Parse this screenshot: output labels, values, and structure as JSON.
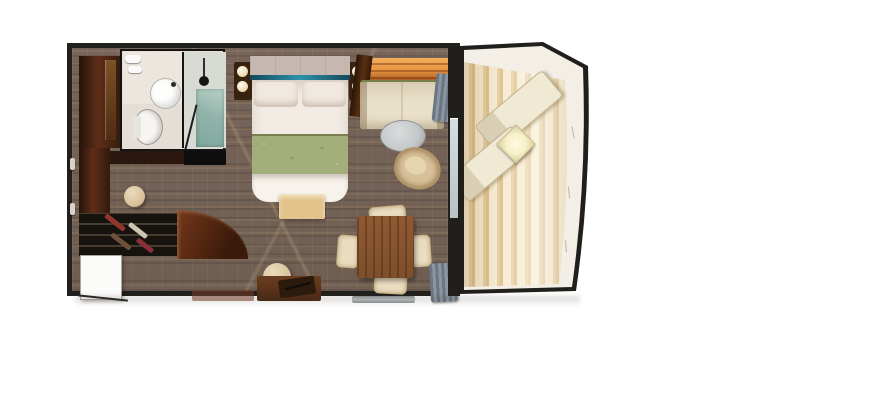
{
  "meta": {
    "title": "Balcony stateroom floor plan",
    "description": "Top-down 3D rendered floor plan of a cruise-ship balcony stateroom with bathroom, dressing area, bedroom, living-dining area and private balcony"
  },
  "rooms": {
    "entry": {
      "label": "Entry with wardrobe and shoe shelves"
    },
    "bathroom": {
      "label": "Bathroom with sink, toilet and glass shower"
    },
    "dressing": {
      "label": "Dressing area with vanity stool and curved cabinet"
    },
    "bedroom": {
      "label": "Bedroom with queen bed, nightstands and bench"
    },
    "living": {
      "label": "Living and dining area with sofa nook, table and desk"
    },
    "balcony": {
      "label": "Private balcony with two loungers and table"
    }
  },
  "items": {
    "bed": {
      "label": "Queen bed with sage green runner and teal headboard accent"
    },
    "sofa": {
      "label": "Cream sofa under backlit shelf"
    },
    "coffee_table": {
      "label": "Round grey coffee table"
    },
    "wicker_chair": {
      "label": "Wicker armchair"
    },
    "dining_table": {
      "label": "Square wood dining table with four cream chairs"
    },
    "desk": {
      "label": "Writing desk with stool"
    },
    "shower": {
      "label": "Glass shower enclosure"
    },
    "toilet": {
      "label": "Toilet"
    },
    "sink": {
      "label": "Round basin on counter"
    },
    "shoe_closet": {
      "label": "Shoe shelving unit"
    },
    "entry_door": {
      "label": "Entry door"
    },
    "balcony_door": {
      "label": "Sliding glass balcony door"
    },
    "loungers": {
      "label": "Two balcony lounge chairs"
    },
    "balcony_table": {
      "label": "Balcony side table"
    }
  },
  "palette": {
    "wall": "#211f1c",
    "carpet": "#6f5e52",
    "carpet_streak": "#a08366",
    "bath_floor": "#e5ded6",
    "shower_glass": "#92b4ab",
    "wood_red": "#5f2e18",
    "linen": "#f1ebe3",
    "runner": "#a3ae7a",
    "accent_teal": "#2b93ab",
    "sofa": "#e9e0ca",
    "backlight": "#e6933f",
    "drape_gray": "#7d8793",
    "table_wood": "#7f4f2b",
    "chair_cream": "#eadcbf",
    "bench": "#e2c38c",
    "stool": "#d8c099",
    "coffee": "#c5c8c8",
    "deck": "#e7cda0",
    "deck_pale": "#f5ead2",
    "railing": "#f3efe7",
    "door": "#fbfbfa"
  }
}
